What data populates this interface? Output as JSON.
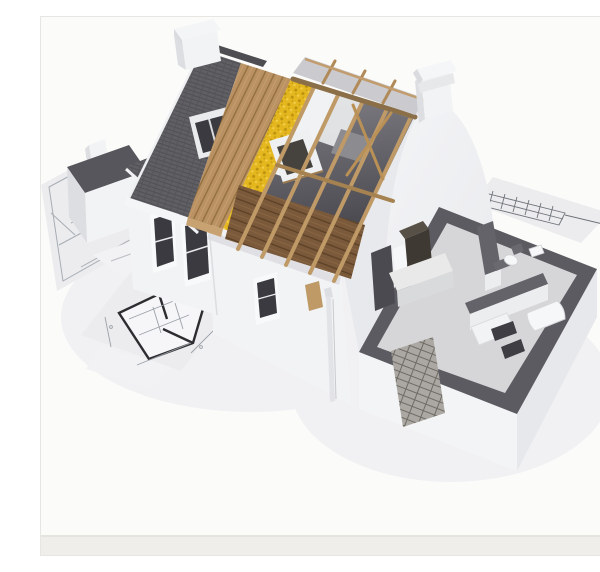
{
  "scene": {
    "alt": "3D architectural rendering of a cutaway model house under construction standing on blueprint drawings: gray shingle roof peeled back to show wooden sheathing, yellow insulation, white panels and exposed timber rafters over an attic floor, with a white Dutch gable, chimneys, and an open-top ground floor plan with dark wall tops, kitchen and bathroom"
  },
  "palette": {
    "background": "#fbfbfa",
    "backgroundStrip": "#f0eeeb",
    "stripLine": "#e5e3de",
    "shadowSoft": "#f1f1f3",
    "paper": "#ececee",
    "paperFaint": "#f2f2f4",
    "paperLine": "#a7adb4",
    "planBold": "#2d2d31",
    "planHatch": "#b7bac0",
    "shingle": "#605f64",
    "shingleLine": "#514ف055",
    "shingleBack": "#4e4d52",
    "wood": "#ba9162",
    "woodLine": "#93703f",
    "insulation": "#e4b71f",
    "insulationDark": "#bb920e",
    "insulationLight": "#f3cf4a",
    "rafter": "#bf9a66",
    "rafterDark": "#8a6f48",
    "purlin": "#a5824f",
    "atticFloor": "#7b5a3b",
    "atticFloorLine": "#5e4226",
    "interiorLight": "#807f85",
    "interiorDark": "#3c3b41",
    "panelWhite": "#f1f2f4",
    "sheathingGray": "#8b8b90",
    "wallWhite": "#f2f3f5",
    "wallShade": "#dddee1",
    "wallShadow": "#d9dade",
    "frameWhite": "#f8f9fa",
    "glassDark": "#3a3a40",
    "gableLight": "#f4f5f7",
    "gableShade": "#e7e8ec",
    "roofDarkTop": "#57565c",
    "wallTop": "#5c5b61",
    "wallTopInner": "#64636a",
    "floorGray": "#d6d6d8",
    "skirtWhite": "#f3f4f6",
    "skirtShade": "#e7e8eb",
    "counter": "#e8e9e8",
    "counterFace": "#d9dadb",
    "unitDark": "#3e3933",
    "unitTop": "#575046",
    "fixtureWhite": "#f6f7f8",
    "fixtureLine": "#d5d6d9",
    "brick": "#aba7a2",
    "brickJoint": "#6f6b64",
    "darkOpening": "#3f3e44",
    "backSlope": "#cbcbcf"
  }
}
